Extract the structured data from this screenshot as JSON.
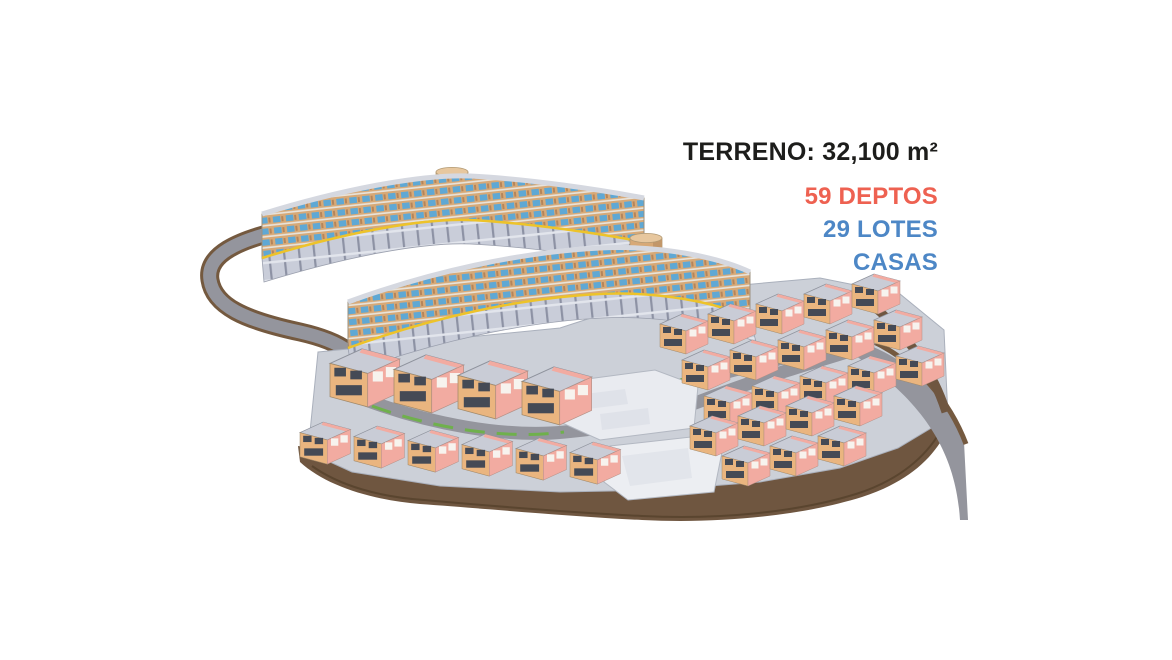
{
  "stats": {
    "terreno": {
      "label": "TERRENO:",
      "value": "32,100 m²",
      "color": "#1d1d1b"
    },
    "deptos": {
      "value": "59 DEPTOS",
      "color": "#ee6151"
    },
    "lotes": {
      "value": "29 LOTES",
      "color": "#4d87c6"
    },
    "casas": {
      "value": "CASAS",
      "color": "#4d87c6"
    }
  },
  "colors": {
    "background": "#ffffff",
    "facade_tan": "#d7a977",
    "facade_shade": "#c2976a",
    "glass_blue": "#5fa8d4",
    "roof_gray": "#c9ccd6",
    "podium_gray": "#c9cdd9",
    "ground_gray": "#ccd0d8",
    "house_tan": "#eab57f",
    "house_pink": "#f2aba1",
    "window_dark": "#454a55",
    "road_gray": "#94959d",
    "road_brown": "#74593f",
    "terrain_brown": "#6f5640",
    "grass_green": "#6fb04c",
    "stripe_yellow": "#edc32a",
    "white_building": "#eceef2",
    "tower_top": "#e7c79e"
  }
}
